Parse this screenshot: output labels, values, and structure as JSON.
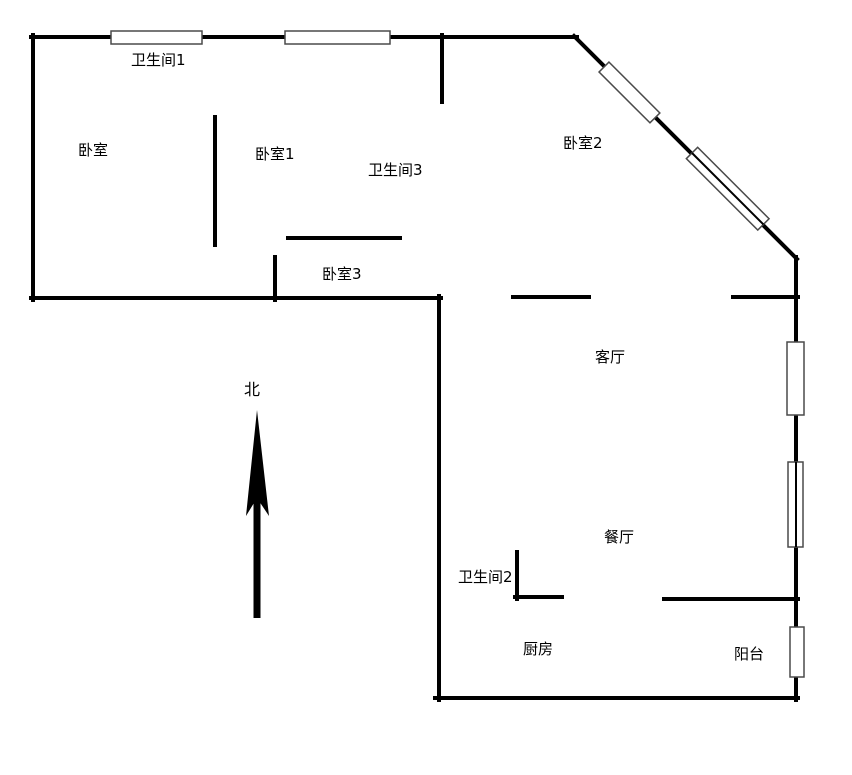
{
  "rooms": [
    {
      "id": "bathroom-1",
      "label": "卫生间1"
    },
    {
      "id": "bedroom",
      "label": "卧室"
    },
    {
      "id": "bedroom-1",
      "label": "卧室1"
    },
    {
      "id": "bathroom-3",
      "label": "卫生间3"
    },
    {
      "id": "bedroom-2",
      "label": "卧室2"
    },
    {
      "id": "bedroom-3",
      "label": "卧室3"
    },
    {
      "id": "living-room",
      "label": "客厅"
    },
    {
      "id": "dining-room",
      "label": "餐厅"
    },
    {
      "id": "bathroom-2",
      "label": "卫生间2"
    },
    {
      "id": "kitchen",
      "label": "厨房"
    },
    {
      "id": "balcony",
      "label": "阳台"
    }
  ],
  "compass": {
    "label": "北"
  },
  "colors": {
    "wall": "#000000",
    "window_border": "#4a4a4a",
    "window_fill": "#ffffff",
    "background": "#ffffff",
    "text": "#000000"
  }
}
